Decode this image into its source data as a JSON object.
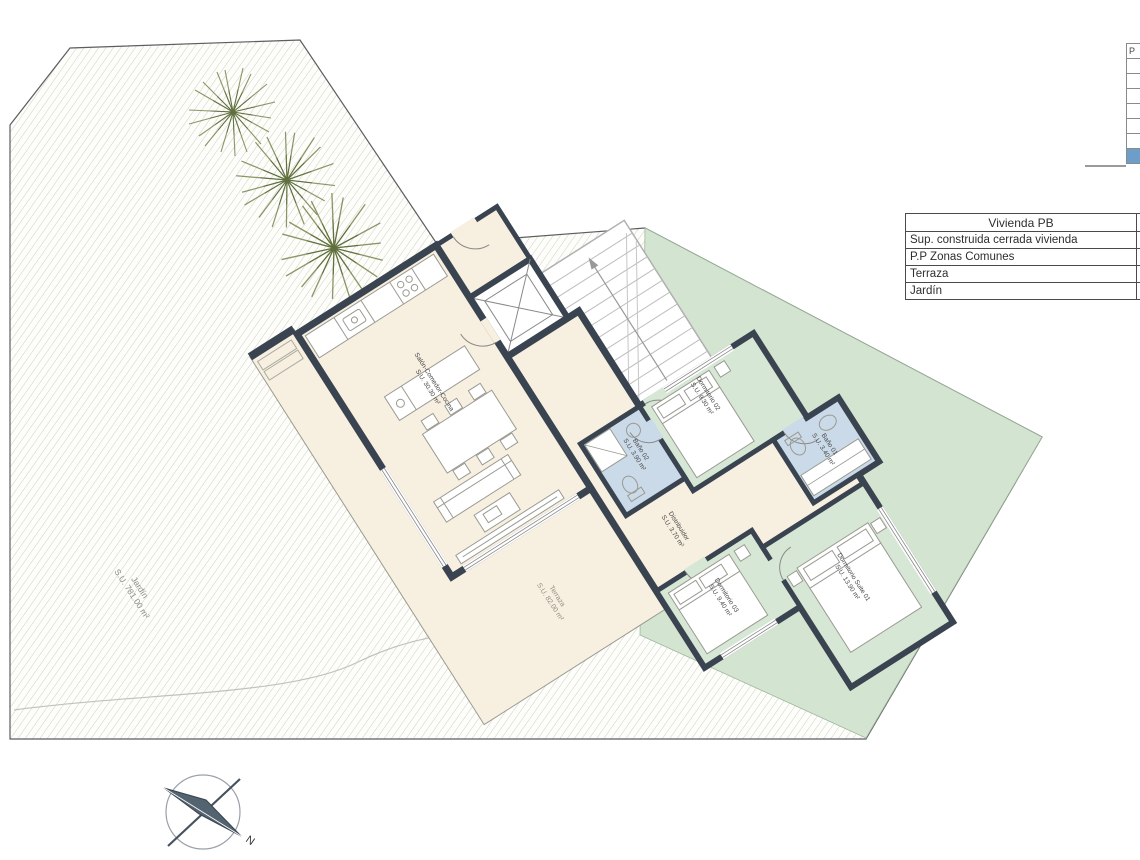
{
  "legend_table": {
    "header": "Vivienda PB",
    "rows": [
      {
        "label": "Sup. construida cerrada vivienda",
        "value": ""
      },
      {
        "label": "P.P Zonas Comunes",
        "value": ""
      },
      {
        "label": "Terraza",
        "value": ""
      },
      {
        "label": "Jardín",
        "value": "1"
      }
    ]
  },
  "floor_selector": {
    "header": "P",
    "selected_color": "#6d9dc9",
    "row_count": 7
  },
  "rooms": {
    "salon": {
      "name": "Salón-Comedor-Cocina",
      "area": "S.U. 30.30 m²"
    },
    "dorm02": {
      "name": "Dormitorio 02",
      "area": "S.U. 9.30 m²"
    },
    "bano02": {
      "name": "Baño 02",
      "area": "S.U. 3.90 m²"
    },
    "bano01": {
      "name": "Baño 01",
      "area": "S.U. 3.40 m²"
    },
    "distribuidor": {
      "name": "Distribuidor",
      "area": "S.U. 3.70 m²"
    },
    "dorm03": {
      "name": "Dormitorio 03",
      "area": "S.U. 9.40 m²"
    },
    "suite": {
      "name": "Dormitorio Suite 01",
      "area": "S.U. 13.90 m²"
    },
    "terraza": {
      "name": "Terraza",
      "area": "S.U. 82.00 m²"
    },
    "jardin": {
      "name": "Jardín",
      "area": "S.U. 781.00 m²"
    }
  },
  "compass": {
    "north": "N"
  },
  "colors": {
    "wall": "#3a4350",
    "floor_cream": "#f7f0e0",
    "floor_green": "#d7e7d6",
    "floor_blue": "#cadae8",
    "garden_green_band": "#d3e4d1",
    "selected_floor": "#6d9dc9"
  }
}
